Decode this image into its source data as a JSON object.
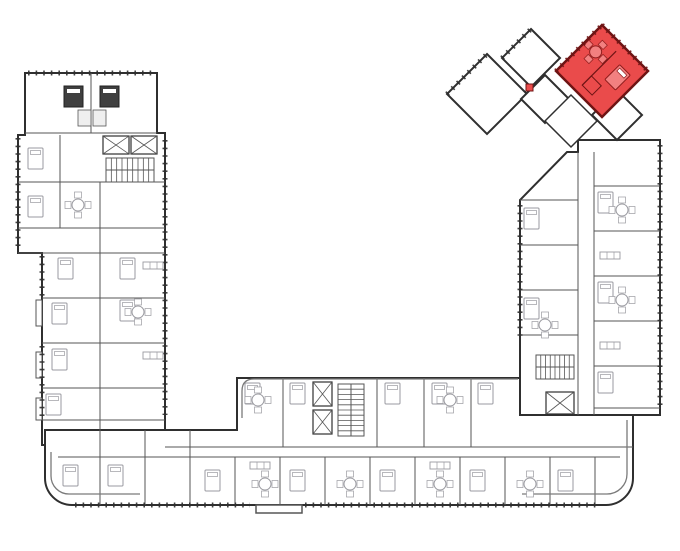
{
  "plan": {
    "aria": "Residential building floor plan, U-shaped, with one apartment highlighted in red in the rotated top-right section"
  },
  "palette": {
    "paper": "#ffffff",
    "outer": "#2f2f2f",
    "inner": "#565656",
    "light": "#9a9aa0",
    "core": "#efefef",
    "highlight": "#ea4b4b",
    "highlight_dark": "#6e1414",
    "band": "#7a7a7a"
  },
  "floorplan": {
    "width": 680,
    "height": 551,
    "shapes": [
      {
        "t": "poly",
        "n": "left-wing",
        "p": [
          [
            25,
            73
          ],
          [
            157,
            73
          ],
          [
            157,
            133
          ],
          [
            165,
            133
          ],
          [
            165,
            445
          ],
          [
            42,
            445
          ],
          [
            42,
            253
          ],
          [
            18,
            253
          ],
          [
            18,
            135
          ],
          [
            25,
            135
          ]
        ],
        "sw": 2,
        "f": "#ffffff"
      },
      {
        "t": "path",
        "n": "bottom-wing",
        "d": "M45,430 H237 V378 H520 V415 H633 V478 A27 27 0 0 1 606 505 H72 A27 27 0 0 1 45 478 Z",
        "sw": 2,
        "f": "#ffffff"
      },
      {
        "t": "poly",
        "n": "right-wing",
        "p": [
          [
            520,
            415
          ],
          [
            520,
            200
          ],
          [
            567,
            152
          ],
          [
            578,
            152
          ],
          [
            578,
            140
          ],
          [
            660,
            140
          ],
          [
            660,
            415
          ]
        ],
        "sw": 2,
        "f": "#ffffff"
      },
      {
        "t": "dia",
        "n": "apartment-unit",
        "c": [
          487,
          94
        ],
        "r": 40,
        "i": true
      },
      {
        "t": "dia",
        "n": "apartment-unit",
        "c": [
          531,
          58
        ],
        "r": 29,
        "i": true
      },
      {
        "t": "dia",
        "n": "apartment-unit",
        "c": [
          545,
          99
        ],
        "r": 24,
        "i": true
      },
      {
        "t": "poly",
        "n": "cluster-corridor",
        "p": [
          [
            545,
            121
          ],
          [
            571,
            95
          ],
          [
            597,
            121
          ],
          [
            571,
            147
          ]
        ],
        "sw": 1.5,
        "f": "#ffffff"
      },
      {
        "t": "dia",
        "n": "apartment-unit",
        "c": [
          617,
          115
        ],
        "r": 25,
        "i": true
      },
      {
        "t": "dia",
        "n": "highlighted-apartment",
        "c": [
          602,
          71
        ],
        "r": 46,
        "f": "#ea4b4b",
        "s": "#6e1414",
        "sw": 2.5,
        "i": true
      },
      {
        "t": "line",
        "x1": 598,
        "y1": 47,
        "x2": 598,
        "y2": 95,
        "s": "#6e1414",
        "sw": 1.2,
        "tr": "rotate(45 602 71)"
      },
      {
        "t": "rect",
        "x": 598,
        "y": 82,
        "w": 14,
        "h": 13,
        "f": "none",
        "s": "#6e1414",
        "sw": 1,
        "n": "bathroom",
        "tr": "rotate(45 602 71)"
      },
      {
        "t": "bed",
        "x": 610,
        "y": 54,
        "s": "#8f1d1d",
        "f": "#f28080",
        "tr": "rotate(45 602 71)"
      },
      {
        "t": "table",
        "x": 584,
        "y": 62,
        "s": "#8f1d1d",
        "f": "#f28080",
        "tr": "rotate(45 602 71)"
      },
      {
        "t": "rect",
        "x": 526,
        "y": 84,
        "w": 7,
        "h": 7,
        "f": "#ea4b4b",
        "s": "#6e1414",
        "sw": 1,
        "n": "highlight-badge"
      },
      {
        "t": "ticks",
        "x1": 556,
        "y1": 71,
        "x2": 602,
        "y2": 25,
        "s": "#6e1414"
      },
      {
        "t": "ticks",
        "x1": 602,
        "y1": 25,
        "x2": 648,
        "y2": 71,
        "s": "#6e1414"
      },
      {
        "t": "ticks",
        "x1": 447,
        "y1": 94,
        "x2": 487,
        "y2": 54
      },
      {
        "t": "ticks",
        "x1": 502,
        "y1": 58,
        "x2": 531,
        "y2": 29
      },
      {
        "t": "line",
        "x1": 91,
        "y1": 73,
        "x2": 91,
        "y2": 133
      },
      {
        "t": "line",
        "x1": 25,
        "y1": 133,
        "x2": 157,
        "y2": 133
      },
      {
        "t": "rect",
        "x": 78,
        "y": 110,
        "w": 13,
        "h": 16,
        "f": "#efefef",
        "sw": 0.8,
        "n": "bathroom"
      },
      {
        "t": "rect",
        "x": 93,
        "y": 110,
        "w": 13,
        "h": 16,
        "f": "#efefef",
        "sw": 0.8,
        "n": "bathroom"
      },
      {
        "t": "bedDark",
        "x": 64,
        "y": 86
      },
      {
        "t": "bedDark",
        "x": 100,
        "y": 86
      },
      {
        "t": "elev",
        "x": 103,
        "y": 136,
        "w": 26,
        "h": 18
      },
      {
        "t": "elev",
        "x": 131,
        "y": 136,
        "w": 26,
        "h": 18
      },
      {
        "t": "stair",
        "x": 106,
        "y": 158,
        "w": 48,
        "h": 24,
        "dir": "h",
        "st": 9
      },
      {
        "t": "line",
        "x1": 18,
        "y1": 182,
        "x2": 165,
        "y2": 182
      },
      {
        "t": "line",
        "x1": 18,
        "y1": 228,
        "x2": 165,
        "y2": 228
      },
      {
        "t": "line",
        "x1": 18,
        "y1": 253,
        "x2": 165,
        "y2": 253
      },
      {
        "t": "line",
        "x1": 42,
        "y1": 298,
        "x2": 165,
        "y2": 298
      },
      {
        "t": "line",
        "x1": 42,
        "y1": 343,
        "x2": 165,
        "y2": 343
      },
      {
        "t": "line",
        "x1": 42,
        "y1": 388,
        "x2": 165,
        "y2": 388
      },
      {
        "t": "line",
        "x1": 42,
        "y1": 420,
        "x2": 165,
        "y2": 420
      },
      {
        "t": "line",
        "x1": 100,
        "y1": 182,
        "x2": 100,
        "y2": 445
      },
      {
        "t": "line",
        "x1": 60,
        "y1": 135,
        "x2": 60,
        "y2": 228
      },
      {
        "t": "rect",
        "x": 36,
        "y": 300,
        "w": 6,
        "h": 26,
        "sw": 1,
        "f": "#ffffff",
        "n": "balcony"
      },
      {
        "t": "rect",
        "x": 36,
        "y": 352,
        "w": 6,
        "h": 26,
        "sw": 1,
        "f": "#ffffff",
        "n": "balcony"
      },
      {
        "t": "rect",
        "x": 36,
        "y": 398,
        "w": 6,
        "h": 22,
        "sw": 1,
        "f": "#ffffff",
        "n": "balcony"
      },
      {
        "t": "line",
        "x1": 165,
        "y1": 447,
        "x2": 633,
        "y2": 447
      },
      {
        "t": "line",
        "x1": 58,
        "y1": 457,
        "x2": 620,
        "y2": 457
      },
      {
        "t": "line",
        "x1": 283,
        "y1": 378,
        "x2": 283,
        "y2": 447
      },
      {
        "t": "line",
        "x1": 377,
        "y1": 378,
        "x2": 377,
        "y2": 447
      },
      {
        "t": "line",
        "x1": 424,
        "y1": 378,
        "x2": 424,
        "y2": 447
      },
      {
        "t": "line",
        "x1": 471,
        "y1": 378,
        "x2": 471,
        "y2": 447
      },
      {
        "t": "elev",
        "x": 313,
        "y": 382,
        "w": 19,
        "h": 24
      },
      {
        "t": "elev",
        "x": 313,
        "y": 410,
        "w": 19,
        "h": 24
      },
      {
        "t": "stair",
        "x": 338,
        "y": 384,
        "w": 26,
        "h": 52,
        "dir": "v",
        "st": 10
      },
      {
        "t": "line",
        "x1": 100,
        "y1": 430,
        "x2": 100,
        "y2": 505
      },
      {
        "t": "line",
        "x1": 145,
        "y1": 430,
        "x2": 145,
        "y2": 505
      },
      {
        "t": "line",
        "x1": 190,
        "y1": 430,
        "x2": 190,
        "y2": 505
      },
      {
        "t": "line",
        "x1": 235,
        "y1": 457,
        "x2": 235,
        "y2": 505
      },
      {
        "t": "line",
        "x1": 280,
        "y1": 457,
        "x2": 280,
        "y2": 505
      },
      {
        "t": "line",
        "x1": 325,
        "y1": 457,
        "x2": 325,
        "y2": 505
      },
      {
        "t": "line",
        "x1": 370,
        "y1": 457,
        "x2": 370,
        "y2": 505
      },
      {
        "t": "line",
        "x1": 415,
        "y1": 457,
        "x2": 415,
        "y2": 505
      },
      {
        "t": "line",
        "x1": 460,
        "y1": 457,
        "x2": 460,
        "y2": 505
      },
      {
        "t": "line",
        "x1": 505,
        "y1": 457,
        "x2": 505,
        "y2": 505
      },
      {
        "t": "line",
        "x1": 550,
        "y1": 457,
        "x2": 550,
        "y2": 505
      },
      {
        "t": "line",
        "x1": 595,
        "y1": 457,
        "x2": 595,
        "y2": 505
      },
      {
        "t": "rect",
        "x": 256,
        "y": 505,
        "w": 46,
        "h": 8,
        "sw": 1.5,
        "f": "#ffffff",
        "n": "entrance-porch"
      },
      {
        "t": "line",
        "x1": 578,
        "y1": 152,
        "x2": 578,
        "y2": 415
      },
      {
        "t": "line",
        "x1": 594,
        "y1": 152,
        "x2": 594,
        "y2": 415
      },
      {
        "t": "line",
        "x1": 520,
        "y1": 200,
        "x2": 578,
        "y2": 200
      },
      {
        "t": "line",
        "x1": 520,
        "y1": 245,
        "x2": 578,
        "y2": 245
      },
      {
        "t": "line",
        "x1": 520,
        "y1": 290,
        "x2": 578,
        "y2": 290
      },
      {
        "t": "line",
        "x1": 520,
        "y1": 335,
        "x2": 578,
        "y2": 335
      },
      {
        "t": "stair",
        "x": 536,
        "y": 355,
        "w": 38,
        "h": 24,
        "dir": "h",
        "st": 8
      },
      {
        "t": "elev",
        "x": 546,
        "y": 392,
        "w": 28,
        "h": 22
      },
      {
        "t": "line",
        "x1": 594,
        "y1": 186,
        "x2": 660,
        "y2": 186
      },
      {
        "t": "line",
        "x1": 594,
        "y1": 231,
        "x2": 660,
        "y2": 231
      },
      {
        "t": "line",
        "x1": 594,
        "y1": 276,
        "x2": 660,
        "y2": 276
      },
      {
        "t": "line",
        "x1": 594,
        "y1": 321,
        "x2": 660,
        "y2": 321
      },
      {
        "t": "line",
        "x1": 594,
        "y1": 366,
        "x2": 660,
        "y2": 366
      },
      {
        "t": "line",
        "x1": 594,
        "y1": 408,
        "x2": 660,
        "y2": 408
      },
      {
        "t": "ticks",
        "x1": 28,
        "y1": 73,
        "x2": 155,
        "y2": 73
      },
      {
        "t": "ticks",
        "x1": 18,
        "y1": 138,
        "x2": 18,
        "y2": 250
      },
      {
        "t": "ticks",
        "x1": 42,
        "y1": 256,
        "x2": 42,
        "y2": 296
      },
      {
        "t": "ticks",
        "x1": 42,
        "y1": 346,
        "x2": 42,
        "y2": 418
      },
      {
        "t": "ticks",
        "x1": 75,
        "y1": 505,
        "x2": 250,
        "y2": 505
      },
      {
        "t": "ticks",
        "x1": 305,
        "y1": 505,
        "x2": 600,
        "y2": 505
      },
      {
        "t": "ticks",
        "x1": 660,
        "y1": 145,
        "x2": 660,
        "y2": 410
      },
      {
        "t": "ticks",
        "x1": 520,
        "y1": 205,
        "x2": 520,
        "y2": 340
      },
      {
        "t": "ticks",
        "x1": 165,
        "y1": 140,
        "x2": 165,
        "y2": 415
      },
      {
        "t": "path",
        "n": "terrace-parapet",
        "d": "M518,379 H254 Q242,379 242,391 V418",
        "sw": 1.3,
        "s": "#7a7a7a",
        "f": "none"
      },
      {
        "t": "path",
        "n": "terrace-parapet",
        "d": "M627,420 V474 A20 20 0 0 1 607,494 H522",
        "sw": 1.3,
        "s": "#7a7a7a",
        "f": "none"
      },
      {
        "t": "path",
        "n": "terrace-parapet",
        "d": "M51,452 V476 A18 18 0 0 0 69,494 H140",
        "sw": 1.3,
        "s": "#7a7a7a",
        "f": "none"
      },
      {
        "t": "bed",
        "x": 28,
        "y": 148
      },
      {
        "t": "bed",
        "x": 28,
        "y": 196
      },
      {
        "t": "bed",
        "x": 58,
        "y": 258
      },
      {
        "t": "bed",
        "x": 52,
        "y": 303
      },
      {
        "t": "bed",
        "x": 52,
        "y": 349
      },
      {
        "t": "bed",
        "x": 46,
        "y": 394
      },
      {
        "t": "bed",
        "x": 120,
        "y": 258
      },
      {
        "t": "bed",
        "x": 120,
        "y": 300
      },
      {
        "t": "bed",
        "x": 245,
        "y": 383
      },
      {
        "t": "bed",
        "x": 290,
        "y": 383
      },
      {
        "t": "bed",
        "x": 385,
        "y": 383
      },
      {
        "t": "bed",
        "x": 432,
        "y": 383
      },
      {
        "t": "bed",
        "x": 478,
        "y": 383
      },
      {
        "t": "bed",
        "x": 63,
        "y": 465
      },
      {
        "t": "bed",
        "x": 108,
        "y": 465
      },
      {
        "t": "bed",
        "x": 205,
        "y": 470
      },
      {
        "t": "bed",
        "x": 290,
        "y": 470
      },
      {
        "t": "bed",
        "x": 380,
        "y": 470
      },
      {
        "t": "bed",
        "x": 470,
        "y": 470
      },
      {
        "t": "bed",
        "x": 558,
        "y": 470
      },
      {
        "t": "bed",
        "x": 598,
        "y": 192
      },
      {
        "t": "bed",
        "x": 598,
        "y": 282
      },
      {
        "t": "bed",
        "x": 598,
        "y": 372
      },
      {
        "t": "bed",
        "x": 524,
        "y": 208
      },
      {
        "t": "bed",
        "x": 524,
        "y": 298
      },
      {
        "t": "table",
        "x": 78,
        "y": 205
      },
      {
        "t": "table",
        "x": 138,
        "y": 312
      },
      {
        "t": "table",
        "x": 265,
        "y": 484
      },
      {
        "t": "table",
        "x": 350,
        "y": 484
      },
      {
        "t": "table",
        "x": 440,
        "y": 484
      },
      {
        "t": "table",
        "x": 530,
        "y": 484
      },
      {
        "t": "table",
        "x": 622,
        "y": 210
      },
      {
        "t": "table",
        "x": 622,
        "y": 300
      },
      {
        "t": "table",
        "x": 545,
        "y": 325
      },
      {
        "t": "table",
        "x": 258,
        "y": 400
      },
      {
        "t": "table",
        "x": 450,
        "y": 400
      },
      {
        "t": "kit",
        "x": 143,
        "y": 262
      },
      {
        "t": "kit",
        "x": 143,
        "y": 352
      },
      {
        "t": "kit",
        "x": 250,
        "y": 462
      },
      {
        "t": "kit",
        "x": 430,
        "y": 462
      },
      {
        "t": "kit",
        "x": 600,
        "y": 252
      },
      {
        "t": "kit",
        "x": 600,
        "y": 342
      }
    ]
  }
}
